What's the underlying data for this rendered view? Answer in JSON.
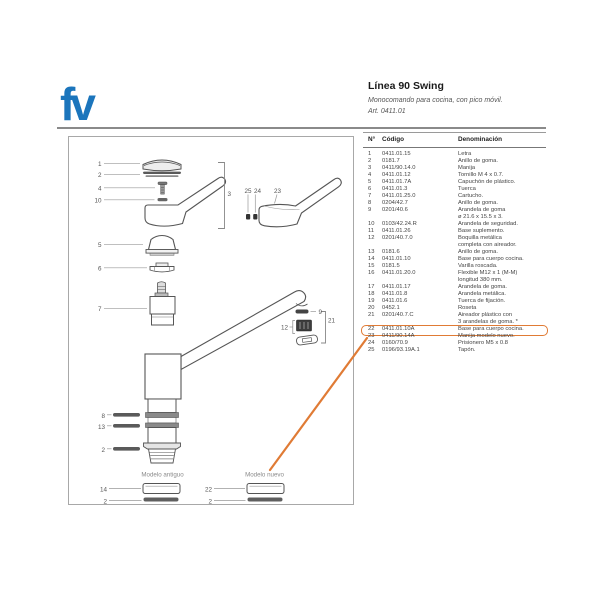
{
  "brand": {
    "logo_text": "fv",
    "color": "#1b75bc"
  },
  "header": {
    "title": "Línea 90 Swing",
    "subtitle": "Monocomando para cocina, con pico móvil.",
    "article": "Art. 0411.01"
  },
  "table": {
    "columns": {
      "n": "N°",
      "code": "Código",
      "name": "Denominación"
    },
    "rows": [
      {
        "n": "1",
        "code": "0411.01.15",
        "name": "Letra"
      },
      {
        "n": "2",
        "code": "0181.7",
        "name": "Anillo de goma."
      },
      {
        "n": "3",
        "code": "0411/90.14.0",
        "name": "Manija"
      },
      {
        "n": "4",
        "code": "0411.01.12",
        "name": "Tornillo M 4 x 0.7."
      },
      {
        "n": "5",
        "code": "0411.01.7A",
        "name": "Capuchón de plástico."
      },
      {
        "n": "6",
        "code": "0411.01.3",
        "name": "Tuerca"
      },
      {
        "n": "7",
        "code": "0411.01.25.0",
        "name": "Cartucho."
      },
      {
        "n": "8",
        "code": "0204/42.7",
        "name": "Anillo de goma."
      },
      {
        "n": "9",
        "code": "0201/40.6",
        "name": "Arandela de goma\nø 21.6 x 15.5 x 3."
      },
      {
        "n": "10",
        "code": "0103/42.24.R",
        "name": "Arandela de seguridad."
      },
      {
        "n": "11",
        "code": "0411.01.26",
        "name": "Base suplemento."
      },
      {
        "n": "12",
        "code": "0201/40.7.0",
        "name": "Boquilla metálica\ncompleta con aireador."
      },
      {
        "n": "13",
        "code": "0181.6",
        "name": "Anillo de goma."
      },
      {
        "n": "14",
        "code": "0411.01.10",
        "name": "Base para cuerpo cocina."
      },
      {
        "n": "15",
        "code": "0181.5",
        "name": "Varilla roscada."
      },
      {
        "n": "16",
        "code": "0411.01.20.0",
        "name": "Flexible M12 x 1 (M-M)\nlongitud 380 mm."
      },
      {
        "n": "17",
        "code": "0411.01.17",
        "name": "Arandela de goma."
      },
      {
        "n": "18",
        "code": "0411.01.8",
        "name": "Arandela metálica."
      },
      {
        "n": "19",
        "code": "0411.01.6",
        "name": "Tuerca de fijación."
      },
      {
        "n": "20",
        "code": "0452.1",
        "name": "Roseta"
      },
      {
        "n": "21",
        "code": "0201/40.7.C",
        "name": "Aireador plástico con\n3 arandelas de goma. *"
      },
      {
        "n": "22",
        "code": "0411.01.10A",
        "name": "Base para cuerpo cocina.",
        "highlighted": true
      },
      {
        "n": "23",
        "code": "0411/90.14A",
        "name": "Manija modelo nuevo."
      },
      {
        "n": "24",
        "code": "0160/70.9",
        "name": "Prisionero M5 x 0.8"
      },
      {
        "n": "25",
        "code": "0196/93.19A.1",
        "name": "Tapón."
      }
    ]
  },
  "diagram": {
    "model_old_label": "Modelo antiguo",
    "model_new_label": "Modelo nuevo",
    "callouts": {
      "c1": "1",
      "c2": "2",
      "c4": "4",
      "c10": "10",
      "c3": "3",
      "c25": "25",
      "c24": "24",
      "c23": "23",
      "c5": "5",
      "c6": "6",
      "c7": "7",
      "c9": "9",
      "c12": "12",
      "c21": "21",
      "c8": "8",
      "c13": "13",
      "c2b": "2",
      "c14": "14",
      "c2c": "2",
      "c22": "22",
      "c2d": "2"
    }
  },
  "highlight": {
    "color": "#e07b35"
  }
}
